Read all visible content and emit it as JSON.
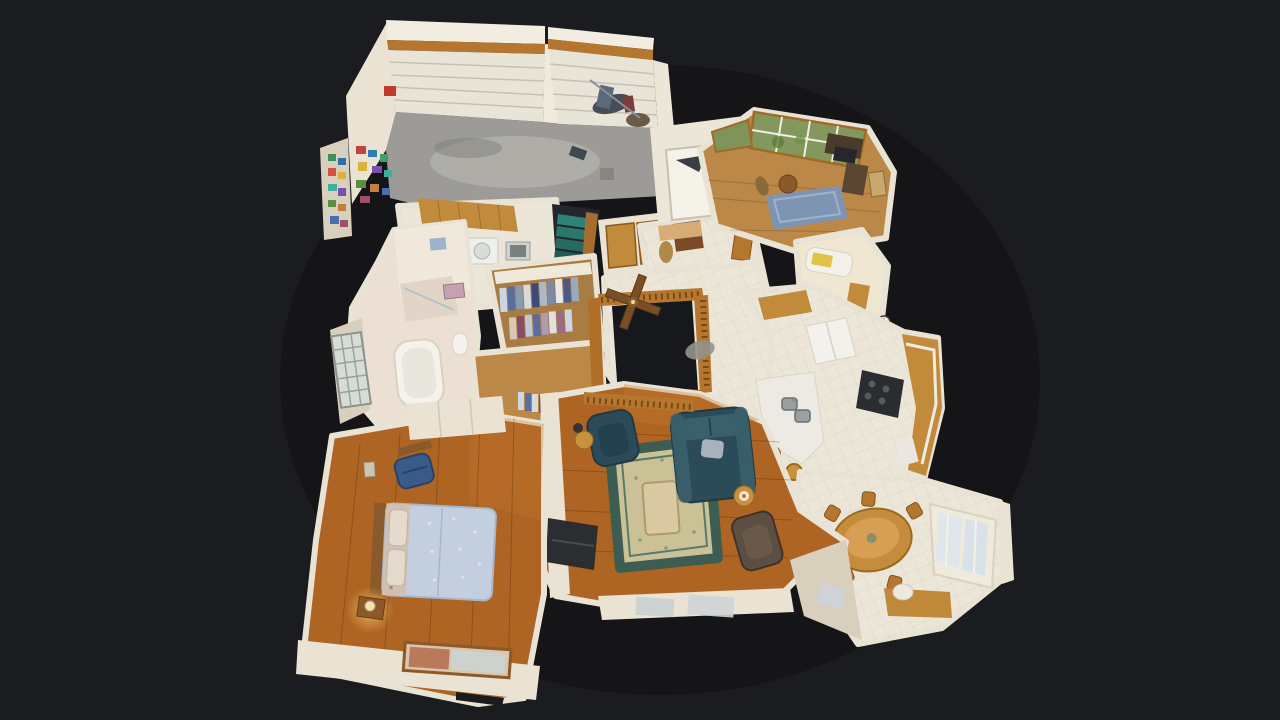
{
  "view": {
    "label": "3d-dollhouse-floorplan-view",
    "style": "matterport-dollhouse"
  },
  "colors": {
    "background": "#1b1c1f",
    "wall": "#eae3d4",
    "wallBright": "#f3ede1",
    "wallShade": "#d8cfbd",
    "tile": "#ece6d9",
    "tileLine": "#d6cfc0",
    "concrete": "#9c9b97",
    "concreteLight": "#bab9b4",
    "woodFloor": "#ae6423",
    "woodFloorLight": "#bb8848",
    "oakCabinet": "#c28b3c",
    "oakTrim": "#b5772f",
    "glassGreen": "#84975c",
    "glassBlue": "#cfd6d2",
    "applianceWhite": "#f2f1ec",
    "stoveBlack": "#2a2c30",
    "stairsTeal": "#2f8276",
    "sofaTeal": "#2b4b58",
    "rugField": "#cbc197",
    "rugBorder": "#3e5d52",
    "officeRug": "#7d94b3",
    "bedQuilt": "#c3cede",
    "pillowFloral": "#cfc0b2",
    "accentBlue": "#3a5a8a",
    "reclinerBrown": "#5c4e42",
    "darkOpening": "#17181c",
    "lampGlow": "#ffe9b0",
    "matBrown": "#7a4a28",
    "garageDoor": "#e9e4d8"
  },
  "rooms": [
    "garage",
    "laundry-room",
    "stairway-down",
    "entry-foyer",
    "coat-closet",
    "office-den",
    "bathroom",
    "master-bathroom",
    "walk-in-closet",
    "hallway",
    "stairwell-opening",
    "kitchen",
    "dining-area",
    "living-room",
    "master-bedroom"
  ]
}
